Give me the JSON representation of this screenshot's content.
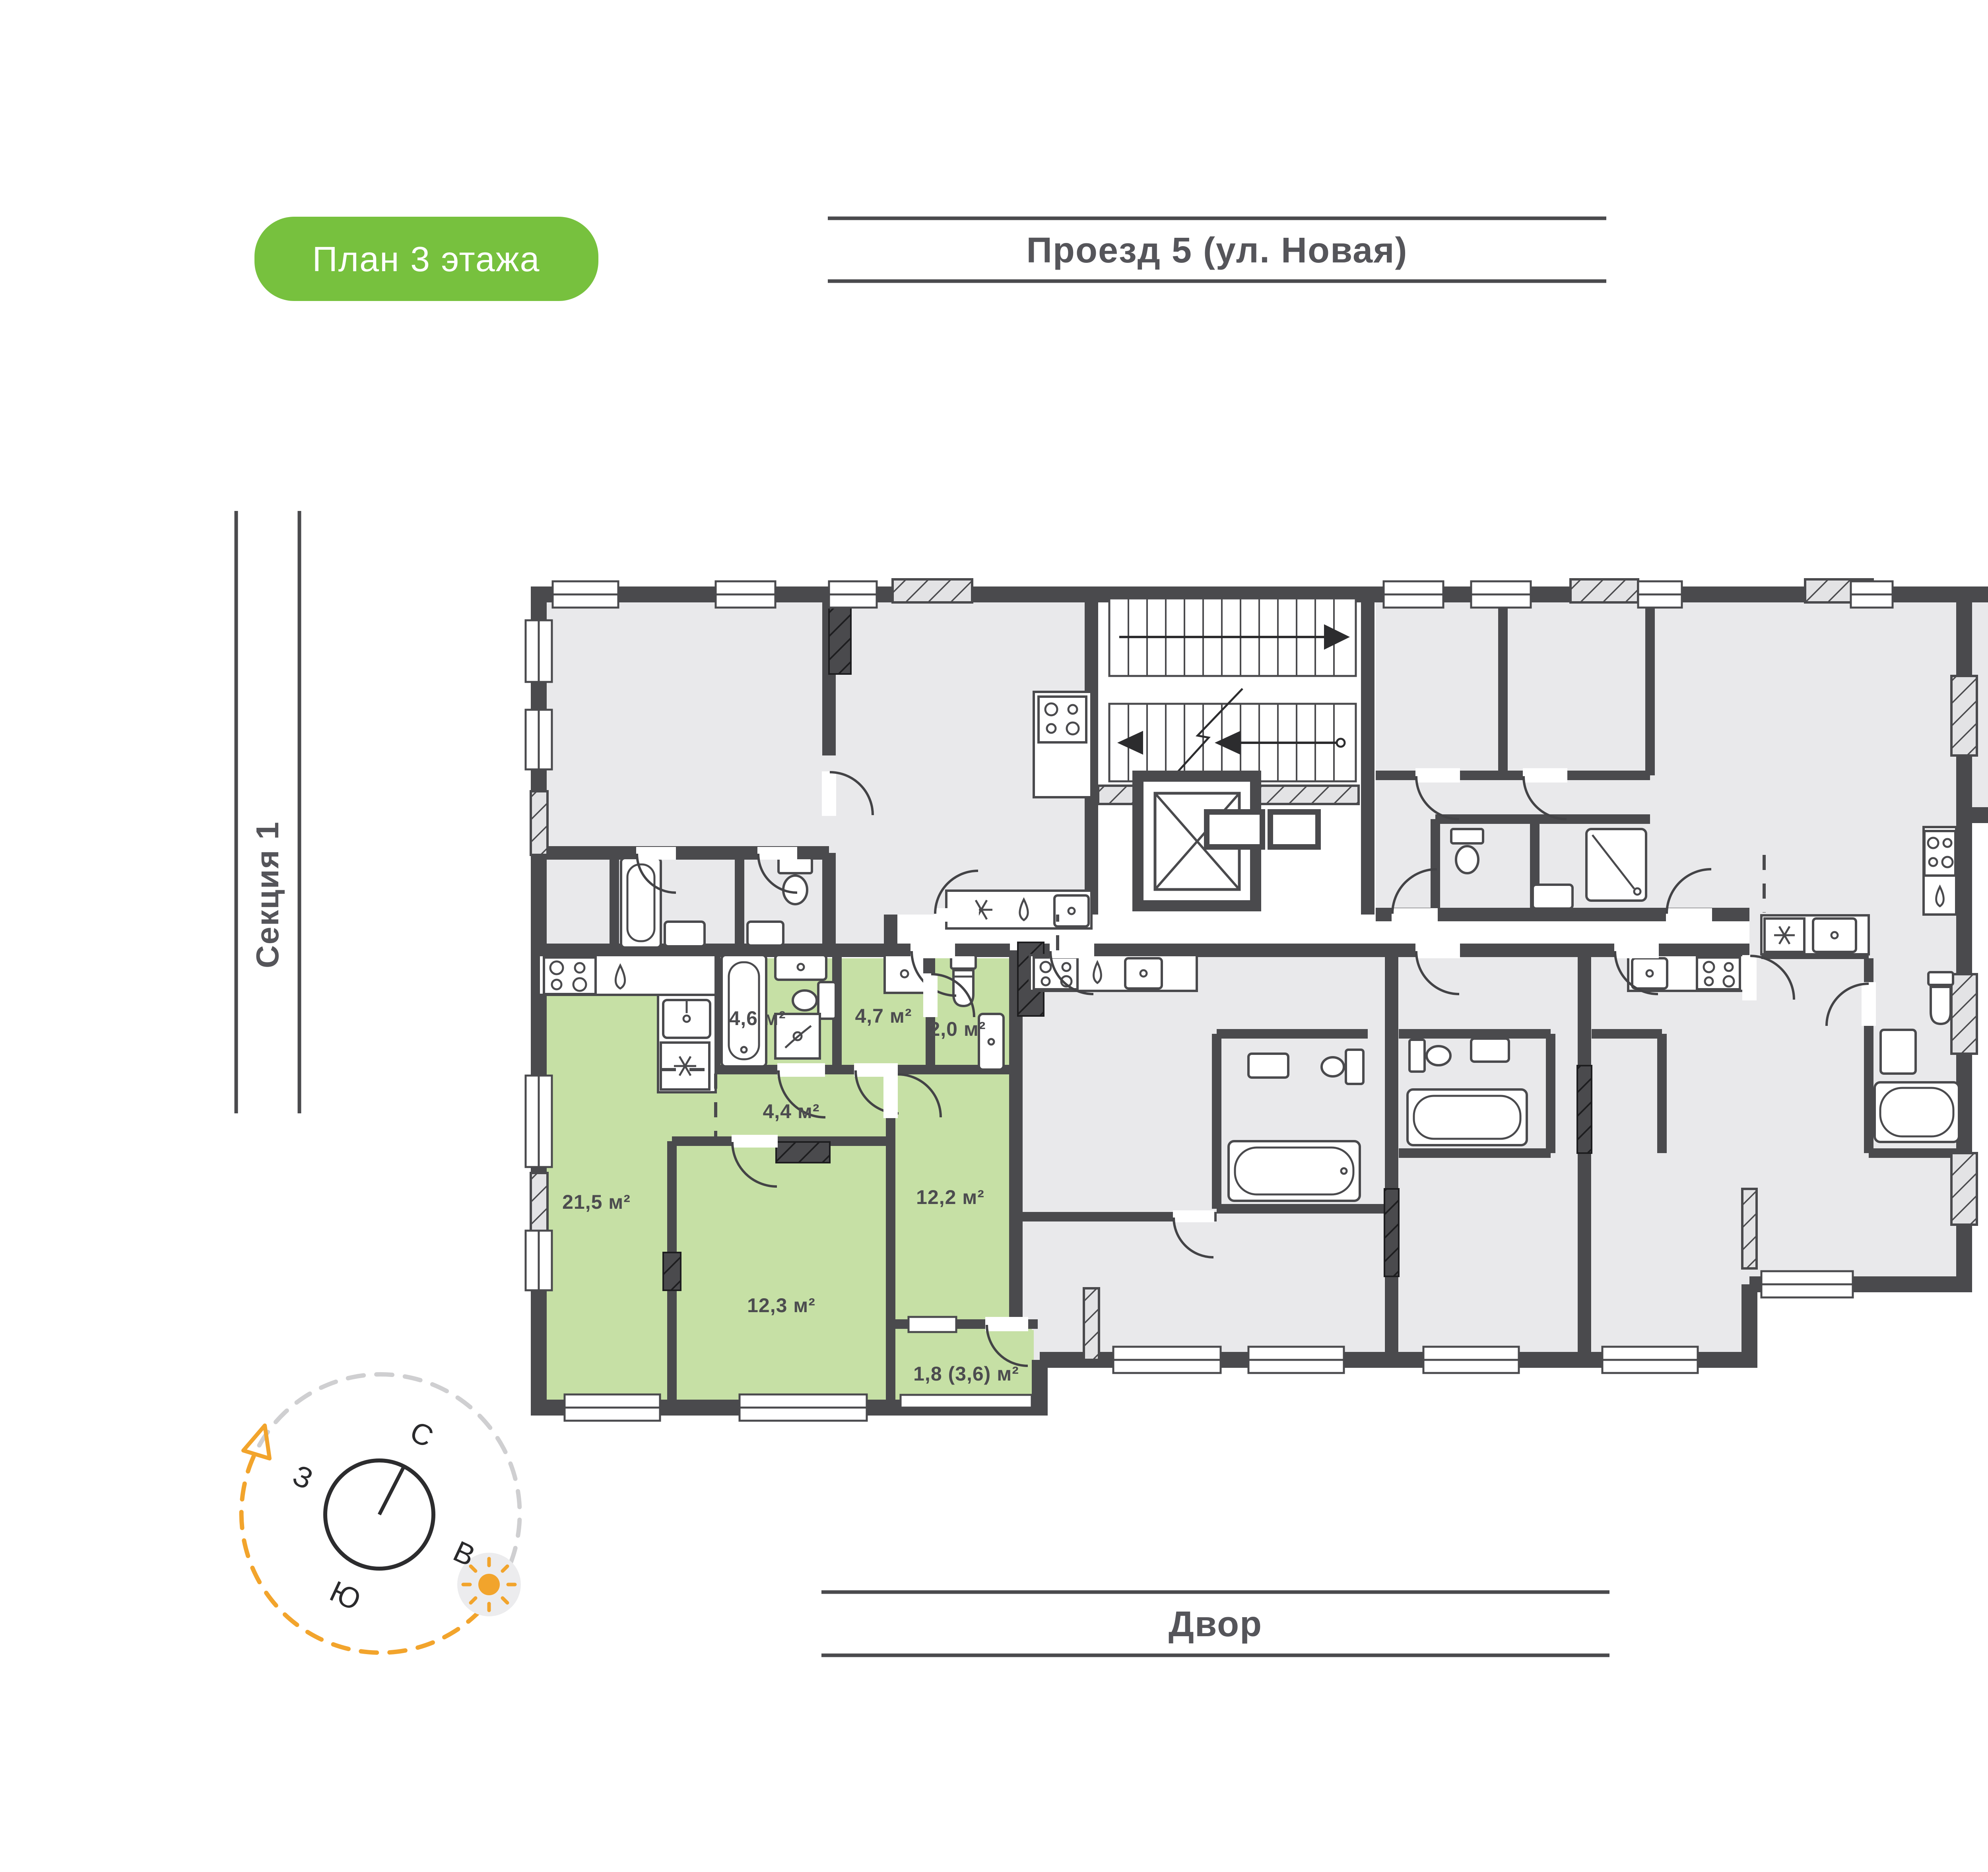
{
  "badge": {
    "label": "План 3 этажа",
    "bg": "#77c13e",
    "text_color": "#ffffff"
  },
  "street": {
    "text": "Проезд 5 (ул. Новая)"
  },
  "yard": {
    "text": "Двор"
  },
  "sections": {
    "left": "Секция 1",
    "right": "Секция 3"
  },
  "compass": {
    "n": "С",
    "s": "Ю",
    "w": "З",
    "e": "В",
    "arc_color": "#f2a42c",
    "sun_color": "#f2a42c"
  },
  "plan": {
    "floor": 3,
    "highlight_color": "#c6e0a5",
    "wall_color": "#4a4a4d",
    "apartment_fill": "#e9e9eb",
    "rooms": [
      {
        "name": "kitchen-living",
        "area": "21,5 м²"
      },
      {
        "name": "bedroom-1",
        "area": "12,3 м²"
      },
      {
        "name": "bedroom-2",
        "area": "12,2 м²"
      },
      {
        "name": "bathroom",
        "area": "4,6 м²"
      },
      {
        "name": "bathroom-2",
        "area": "4,7 м²"
      },
      {
        "name": "wc",
        "area": "2,0 м²"
      },
      {
        "name": "hall",
        "area": "4,4 м²"
      },
      {
        "name": "balcony",
        "area": "1,8 (3,6) м²"
      }
    ]
  }
}
